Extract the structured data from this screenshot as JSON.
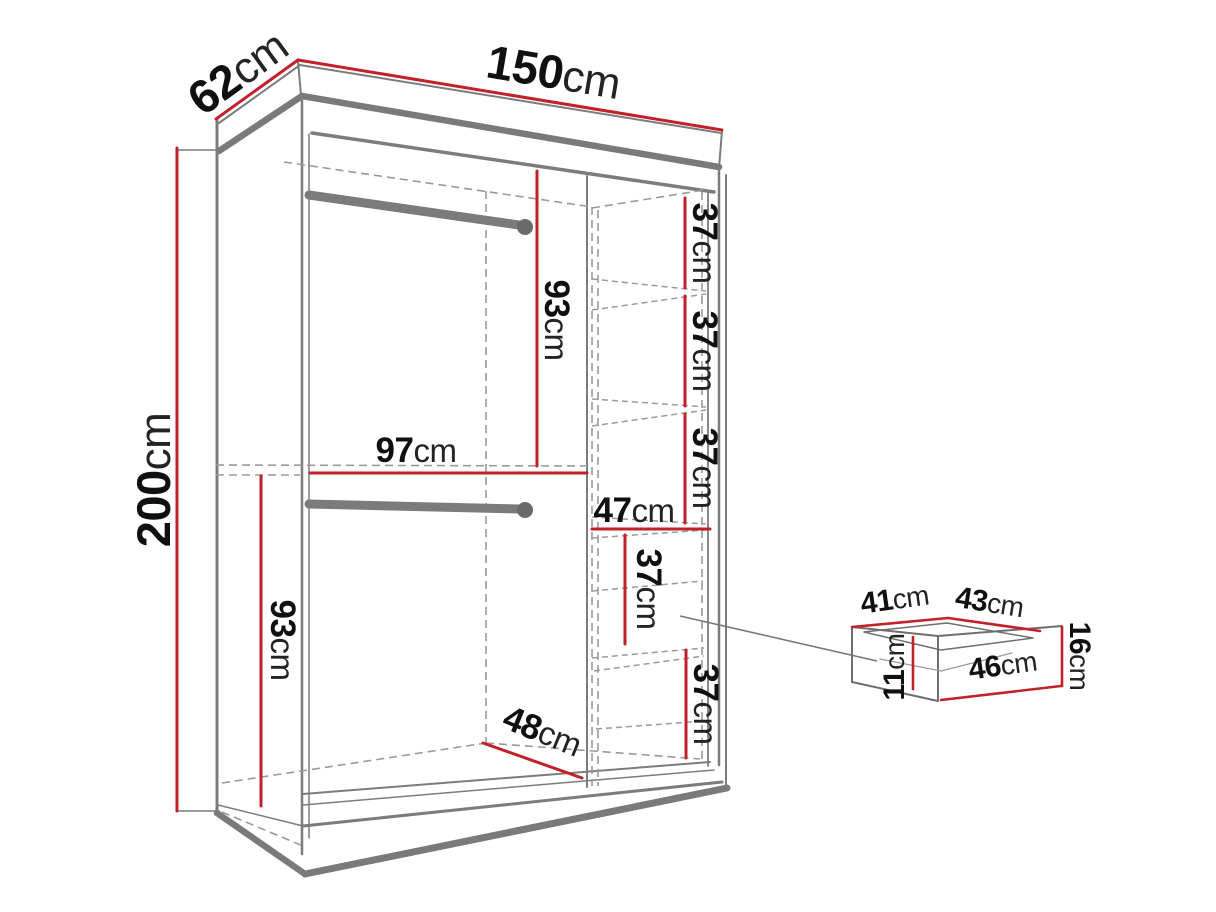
{
  "diagram": {
    "title": "Wardrobe dimension diagram with drawer detail",
    "colors": {
      "dimension_red": "#c2202a",
      "structure_gray": "#7c7c7c",
      "thick_gray": "#7a7a7a",
      "dashed_gray": "#9a9a9a",
      "rod_gray": "#7b7b7b",
      "text_black": "#101010",
      "background": "#ffffff"
    },
    "dimensions": {
      "depth": {
        "value": "62",
        "unit": "cm"
      },
      "width": {
        "value": "150",
        "unit": "cm"
      },
      "height": {
        "value": "200",
        "unit": "cm"
      },
      "top_rod_height": {
        "value": "93",
        "unit": "cm"
      },
      "left_section_width": {
        "value": "97",
        "unit": "cm"
      },
      "bottom_rod_height": {
        "value": "93",
        "unit": "cm"
      },
      "base_depth": {
        "value": "48",
        "unit": "cm"
      },
      "shelf_column_width": {
        "value": "47",
        "unit": "cm"
      },
      "shelves": [
        {
          "value": "37",
          "unit": "cm"
        },
        {
          "value": "37",
          "unit": "cm"
        },
        {
          "value": "37",
          "unit": "cm"
        },
        {
          "value": "37",
          "unit": "cm"
        },
        {
          "value": "37",
          "unit": "cm"
        }
      ]
    },
    "drawer_detail": {
      "top_left_width": {
        "value": "41",
        "unit": "cm"
      },
      "top_right_width": {
        "value": "43",
        "unit": "cm"
      },
      "inner_height": {
        "value": "11",
        "unit": "cm"
      },
      "front_height": {
        "value": "16",
        "unit": "cm"
      },
      "front_width": {
        "value": "46",
        "unit": "cm"
      }
    }
  }
}
